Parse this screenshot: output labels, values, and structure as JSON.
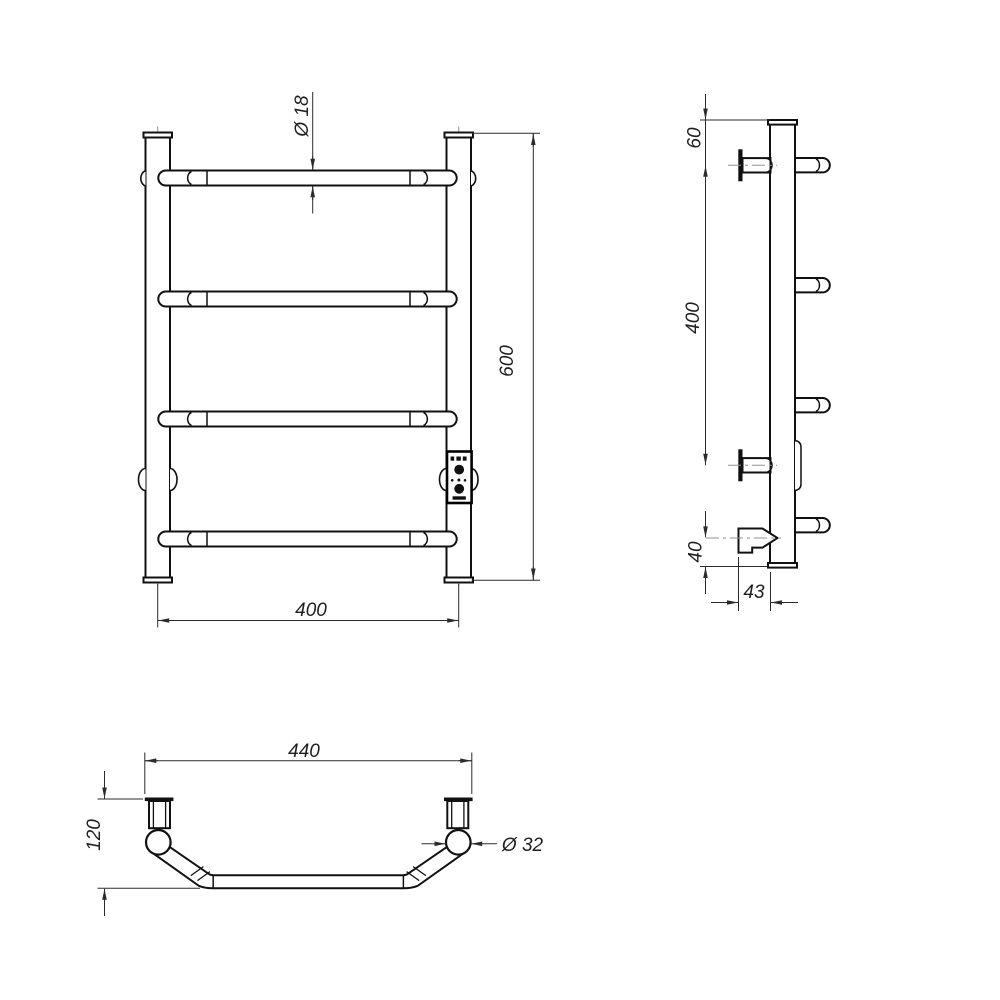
{
  "page": {
    "background": "#ffffff"
  },
  "drawing": {
    "line_color": "#111111",
    "dim_color": "#2b2b2b",
    "centerline_color": "#909090",
    "views": {
      "front": {
        "diameter_label": "Ø 18",
        "height_label": "600",
        "width_label": "400"
      },
      "side": {
        "top_offset_label": "60",
        "bracket_spacing_label": "400",
        "bottom_offset_label": "40",
        "depth_label": "43"
      },
      "top": {
        "width_label": "440",
        "depth_label": "120",
        "post_diameter_label": "Ø 32"
      }
    },
    "control_panel": {
      "icons": [
        "led-row-icon",
        "power-button-icon",
        "dot-row-icon",
        "mode-button-icon",
        "slot-icon"
      ]
    }
  }
}
